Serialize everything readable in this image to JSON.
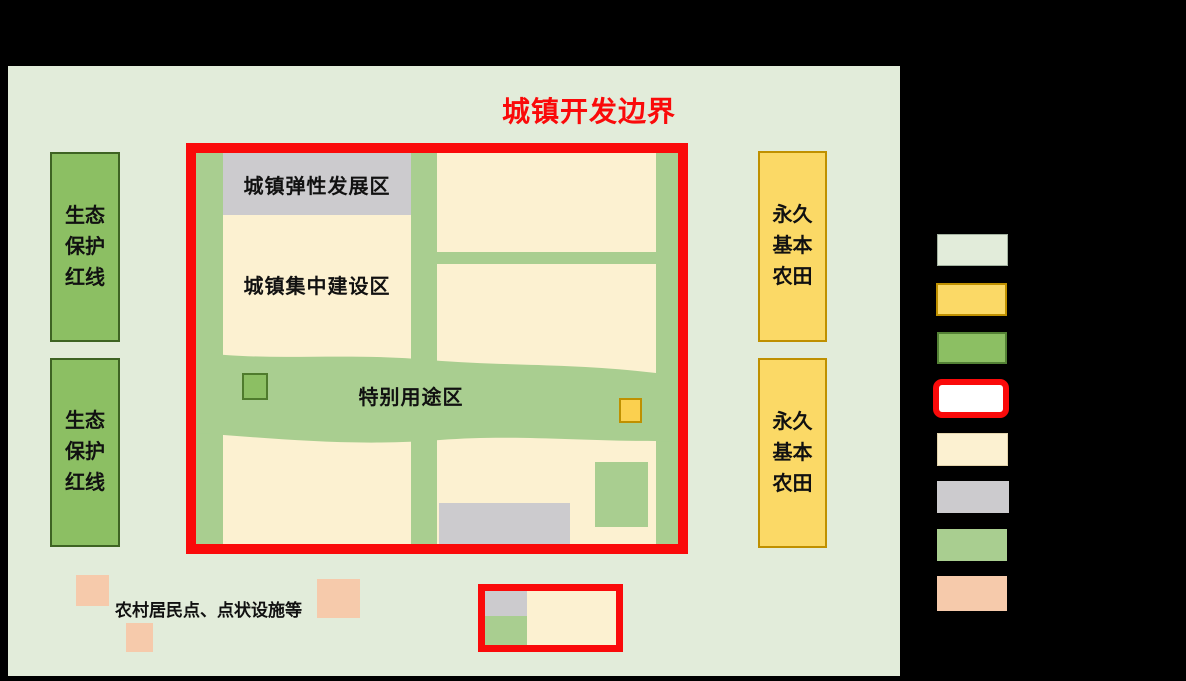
{
  "page": {
    "background": "#000000"
  },
  "title": {
    "text": "城镇开发边界",
    "color": "#FA0A0A"
  },
  "labels": {
    "eco": "生态\n保护\n红线",
    "farm": "永久\n基本\n农田",
    "flex_zone": "城镇弹性发展区",
    "build_zone": "城镇集中建设区",
    "special_zone": "特别用途区",
    "rural": "农村居民点、点状设施等"
  },
  "colors": {
    "boundary_red": "#FA0A0A",
    "panel_green": "#E2ECDA",
    "road_green": "#A9CE90",
    "eco_green": "#8CBF63",
    "eco_green_border": "#3E6323",
    "farm_yellow": "#FBD966",
    "farm_yellow_border": "#BF9000",
    "cream": "#FCF1D1",
    "gray": "#CCCBCE",
    "peach": "#F6CAAB",
    "small_green_border": "#4F7B2D",
    "small_yellow": "#FBD04F"
  },
  "legend": {
    "swatches": [
      {
        "name": "pale-green",
        "fill": "#E2ECDA",
        "border": "#A3B2A0"
      },
      {
        "name": "yellow",
        "fill": "#FBD966",
        "border": "#BF9000"
      },
      {
        "name": "green",
        "fill": "#8CBF63",
        "border": "#538135"
      },
      {
        "name": "white-red-outline",
        "fill": "#FFFFFF",
        "border": "#FA0A0A"
      },
      {
        "name": "cream",
        "fill": "#FCF1D1",
        "border": "#E3D4AC"
      },
      {
        "name": "gray",
        "fill": "#CCCBCE",
        "border": "none"
      },
      {
        "name": "road-green",
        "fill": "#A9CE90",
        "border": "none"
      },
      {
        "name": "peach",
        "fill": "#F6CAAB",
        "border": "none"
      }
    ]
  }
}
